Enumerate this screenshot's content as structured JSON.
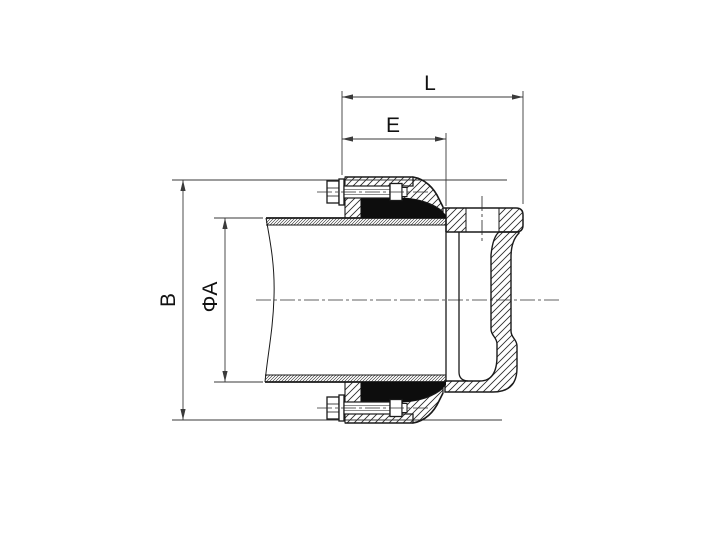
{
  "page": {
    "background": "#ffffff"
  },
  "drawing": {
    "kind": "pipe-end-coupling-cross-section",
    "line_color": "#1a1a1a",
    "dimension_line_color": "#3a3a3a",
    "seal_color": "#0d0d0d",
    "labels": {
      "overall_length": "L",
      "engagement_length": "E",
      "body_diameter": "B",
      "pipe_diameter": "ΦA"
    }
  }
}
